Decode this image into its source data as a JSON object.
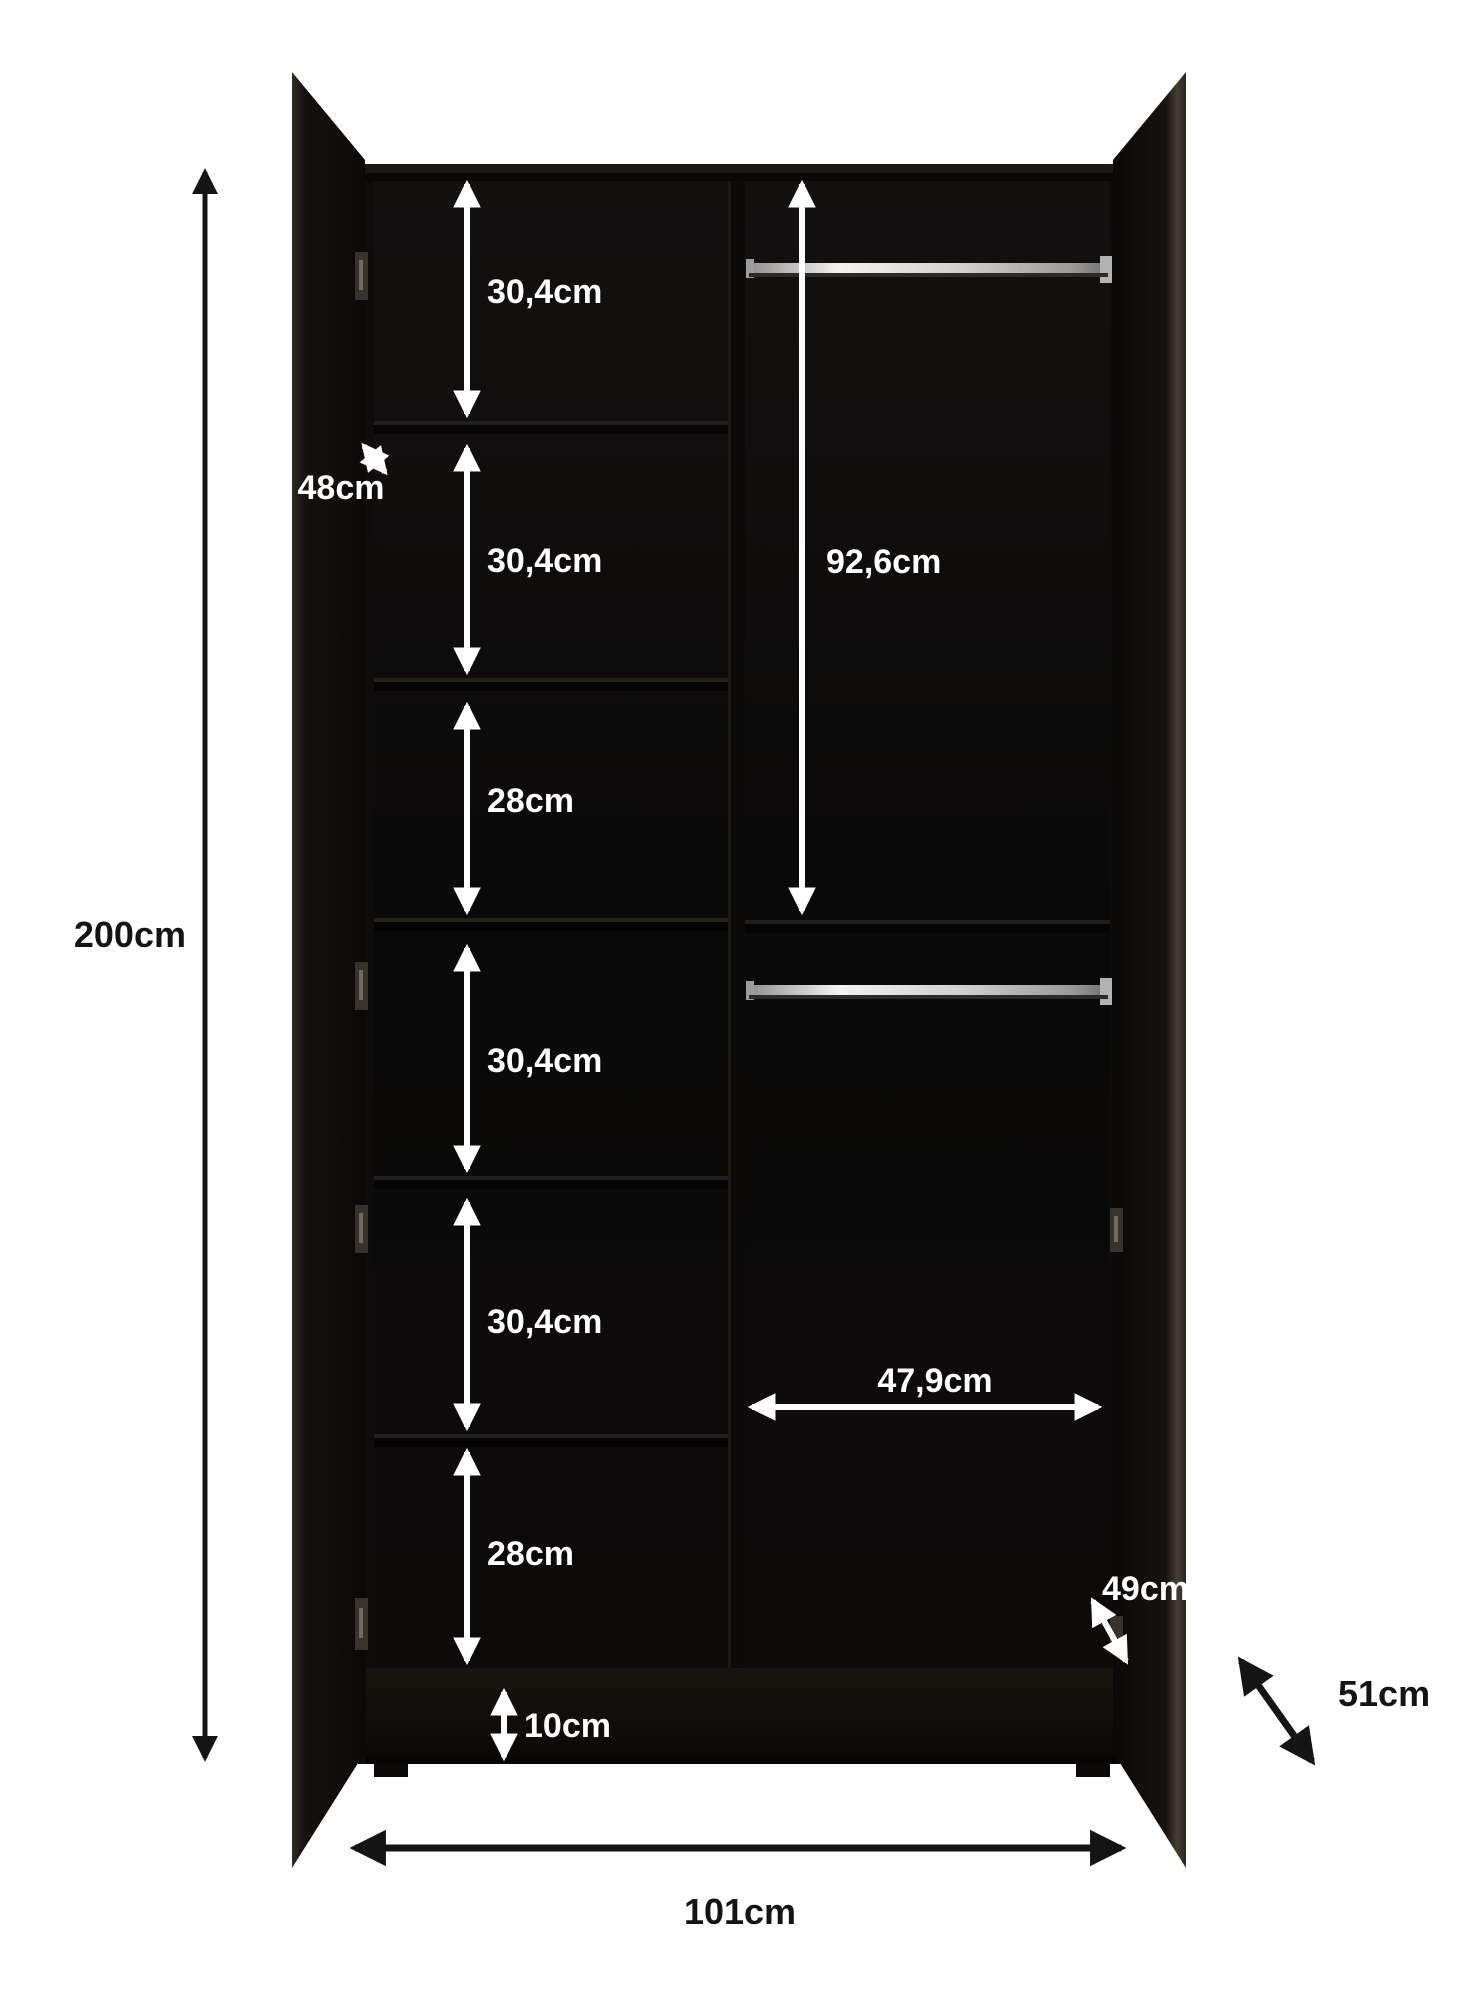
{
  "diagram": {
    "subject": "wardrobe-dimension-diagram",
    "unit": "cm"
  },
  "measurements": {
    "total_height": "200cm",
    "total_width": "101cm",
    "external_depth": "51cm",
    "internal_depth": "49cm",
    "shelf_depth": "48cm",
    "hanging_height": "92,6cm",
    "hanging_section_width": "47,9cm",
    "plinth_height": "10cm",
    "left_column_sections": [
      "30,4cm",
      "30,4cm",
      "28cm",
      "30,4cm",
      "30,4cm",
      "28cm"
    ]
  },
  "colors": {
    "background": "#ffffff",
    "cabinet_dark": "#0c0a09",
    "door_edge_light": "#463d33",
    "rail_chrome": "#e9e9e9",
    "label_white": "#ffffff",
    "label_black": "#141414"
  }
}
